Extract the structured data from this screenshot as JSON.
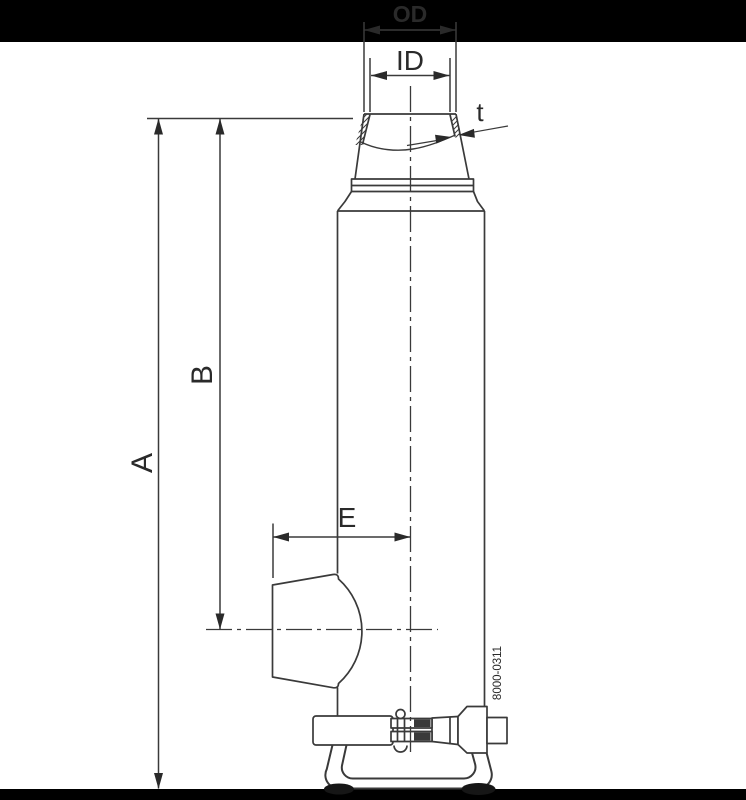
{
  "drawing": {
    "title_hint": "technical dimension drawing of a cylindrical vessel with tangential outlet and clamp connection",
    "labels": {
      "outer_diameter": "OD",
      "inner_diameter": "ID",
      "wall_thickness": "t",
      "overall_height": "A",
      "outlet_centerline_height": "B",
      "outlet_reach": "E"
    },
    "part_number": "8000-0311",
    "colors": {
      "background": "#ffffff",
      "letterbox": "#000000",
      "line": "#3a3a3a",
      "text": "#2a2a2a",
      "shadow": "#161616"
    }
  }
}
